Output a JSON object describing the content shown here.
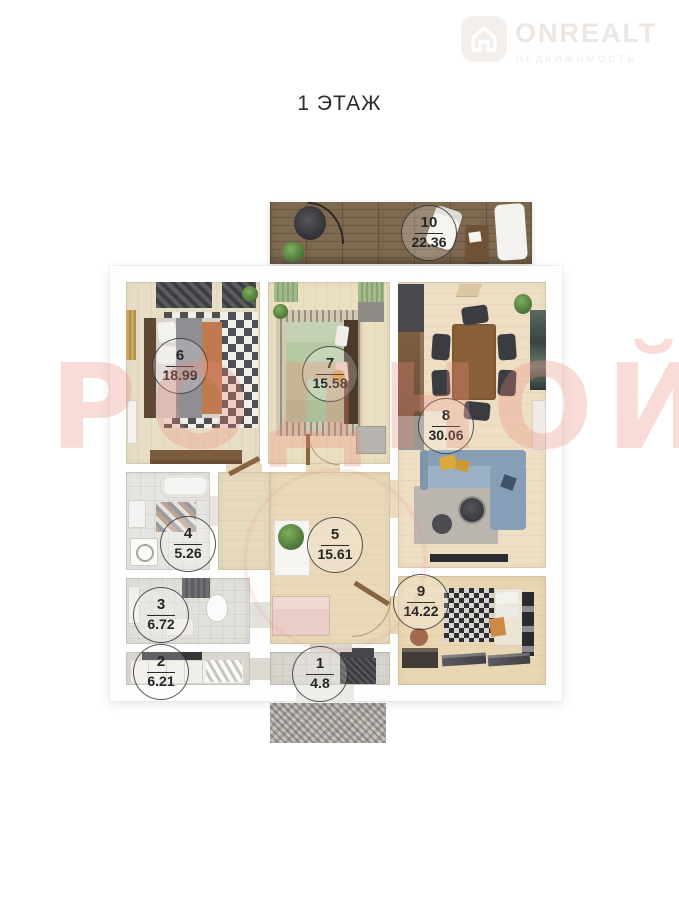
{
  "header": {
    "title": "1 ЭТАЖ"
  },
  "logo": {
    "name": "ONREALT",
    "tagline": "НЕДВИЖИМОСТЬ",
    "icon": "house-icon"
  },
  "watermark": {
    "text": "РОДНОЙ",
    "color": "#eb8c7a"
  },
  "floorplan": {
    "rooms": [
      {
        "number": "1",
        "area": "4.8"
      },
      {
        "number": "2",
        "area": "6.21"
      },
      {
        "number": "3",
        "area": "6.72"
      },
      {
        "number": "4",
        "area": "5.26"
      },
      {
        "number": "5",
        "area": "15.61"
      },
      {
        "number": "6",
        "area": "18.99"
      },
      {
        "number": "7",
        "area": "15.58"
      },
      {
        "number": "8",
        "area": "30.06"
      },
      {
        "number": "9",
        "area": "14.22"
      },
      {
        "number": "10",
        "area": "22.36"
      }
    ],
    "colors": {
      "terrace_wood": "#76634a",
      "sofa_blue": "#8fa6bb",
      "bed_green": "#b6c9a3",
      "floor_beige": "#e8dcc2"
    }
  }
}
